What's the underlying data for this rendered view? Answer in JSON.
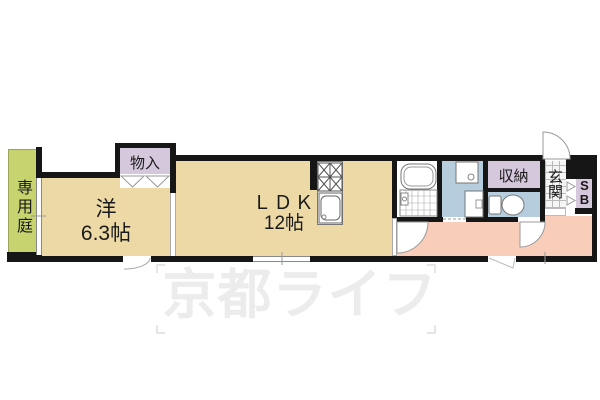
{
  "floorplan": {
    "garden": {
      "label": "専用庭"
    },
    "western_room": {
      "name": "洋",
      "size": "6.3帖"
    },
    "closet": {
      "label": "物入"
    },
    "ldk": {
      "name": "ＬＤＫ",
      "size": "12帖"
    },
    "storage": {
      "label": "収納"
    },
    "entrance": {
      "label": "玄関"
    },
    "shoebox": {
      "letters": [
        "S",
        "B"
      ]
    },
    "colors": {
      "wall": "#161616",
      "room_tan": "#ecd9a6",
      "garden_green": "#c6d36f",
      "closet_lavender": "#d6c8dc",
      "wet_blue": "#b6cdde",
      "hall_pink": "#f8cdba"
    }
  },
  "watermark": {
    "text": "京都ライフ"
  }
}
